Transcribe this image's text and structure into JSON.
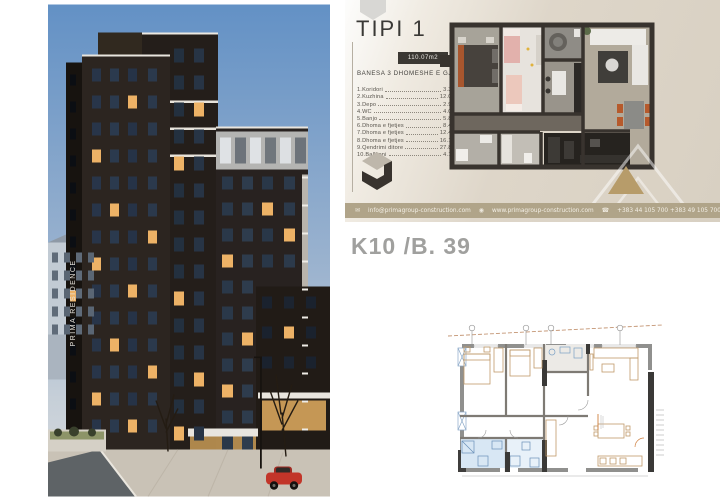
{
  "tipi_card": {
    "title": "TIPI 1",
    "area_badge": "110.07m2",
    "subtitle": "BANESA 3 DHOMESHE E GJYSEM",
    "rooms": [
      {
        "label": "1.Koridori",
        "area": "3.37m2"
      },
      {
        "label": "2.Kuzhina",
        "area": "12.03m2"
      },
      {
        "label": "3.Depo",
        "area": "2.94m2"
      },
      {
        "label": "4.WC",
        "area": "4.02m2"
      },
      {
        "label": "5.Banjo",
        "area": "5.82m2"
      },
      {
        "label": "6.Dhoma e fjetjes",
        "area": "8.48m2"
      },
      {
        "label": "7.Dhoma e fjetjes",
        "area": "12.47m2"
      },
      {
        "label": "8.Dhoma e fjetjes",
        "area": "16.10m2"
      },
      {
        "label": "9.Qendrimi ditore",
        "area": "27.86m2"
      },
      {
        "label": "10.Ballkoni",
        "area": "4.18m2"
      }
    ],
    "contact": {
      "email": "info@primagroup-construction.com",
      "website": "www.primagroup-construction.com",
      "phones": "+383 44 105 700  +383 49 105 700"
    },
    "icons": {
      "email": "✉",
      "website": "◉",
      "phone": "☎"
    }
  },
  "unit_label": "K10 /B. 39",
  "building": {
    "vertical_sign": "PRIMA RESIDENCE"
  },
  "colors": {
    "card_bg": "#ded6c9",
    "contact_strip": "#b0a489",
    "accent_tan": "#b79c6a",
    "wall_dark": "#38332e",
    "unit_label_gray": "#a0a09e",
    "lit_window": "#edb266",
    "sky_top": "#6391c5",
    "highlight_blue": "#d8e7f4"
  }
}
